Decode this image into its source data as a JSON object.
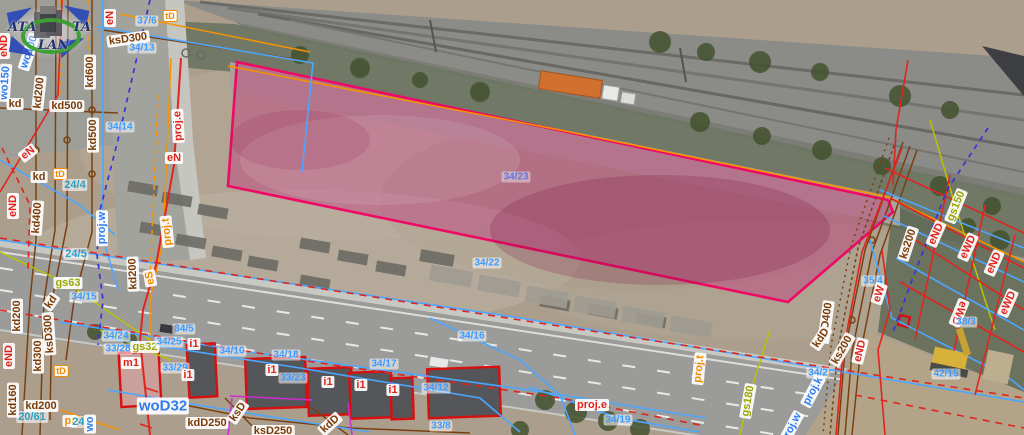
{
  "watermark": {
    "left": "ATA",
    "right": "TA",
    "bottom": "LAN"
  },
  "selected_parcel": {
    "number": "34/23",
    "outline_color": "#ee0a64",
    "fill_color": "#c2357f"
  },
  "palette": {
    "cadastral_blue": "#4da6ff",
    "utility_red": "#e0251f",
    "sewer_brown": "#7a4012",
    "telecom_orange": "#f59300",
    "gas_olive": "#b8c400",
    "proj_navy": "#3434d8",
    "magenta": "#cf2bd0"
  },
  "labels": [
    {
      "t": "eN",
      "x": 110,
      "y": 18,
      "r": -90,
      "k": "red"
    },
    {
      "t": "eND",
      "x": 4,
      "y": 46,
      "r": -90,
      "k": "red"
    },
    {
      "t": "ksD300",
      "x": 128,
      "y": 39,
      "r": -8,
      "k": "brown"
    },
    {
      "t": "34/13",
      "x": 142,
      "y": 48,
      "r": 0,
      "k": "parcel"
    },
    {
      "t": "37/6",
      "x": 147,
      "y": 21,
      "r": 0,
      "k": "parcel"
    },
    {
      "t": "tD",
      "x": 170,
      "y": 16,
      "r": 0,
      "k": "obox"
    },
    {
      "t": "wo100",
      "x": 29,
      "y": 52,
      "r": -72,
      "k": "blue"
    },
    {
      "t": "wo150",
      "x": 5,
      "y": 83,
      "r": -86,
      "k": "blue"
    },
    {
      "t": "kd600",
      "x": 90,
      "y": 72,
      "r": -90,
      "k": "brown"
    },
    {
      "t": "kd",
      "x": 15,
      "y": 104,
      "r": 0,
      "k": "brown"
    },
    {
      "t": "kd200",
      "x": 39,
      "y": 93,
      "r": -84,
      "k": "brown"
    },
    {
      "t": "kd500",
      "x": 67,
      "y": 106,
      "r": 0,
      "k": "brown"
    },
    {
      "t": "kd500",
      "x": 93,
      "y": 135,
      "r": -90,
      "k": "brown"
    },
    {
      "t": "34/14",
      "x": 120,
      "y": 127,
      "r": 0,
      "k": "parcel"
    },
    {
      "t": "eN",
      "x": 28,
      "y": 153,
      "r": -38,
      "k": "red"
    },
    {
      "t": "kd",
      "x": 39,
      "y": 177,
      "r": 0,
      "k": "brown"
    },
    {
      "t": "tD",
      "x": 60,
      "y": 174,
      "r": 0,
      "k": "obox"
    },
    {
      "t": "24/4",
      "x": 75,
      "y": 185,
      "r": 0,
      "k": "teal"
    },
    {
      "t": "eND",
      "x": 13,
      "y": 206,
      "r": -90,
      "k": "red"
    },
    {
      "t": "kd400",
      "x": 37,
      "y": 218,
      "r": -86,
      "k": "brown"
    },
    {
      "t": "proj.w",
      "x": 102,
      "y": 228,
      "r": -90,
      "k": "blue"
    },
    {
      "t": "proj.e",
      "x": 178,
      "y": 126,
      "r": -93,
      "k": "red"
    },
    {
      "t": "eN",
      "x": 174,
      "y": 158,
      "r": 0,
      "k": "red"
    },
    {
      "t": "proj.t",
      "x": 167,
      "y": 232,
      "r": -96,
      "k": "orange"
    },
    {
      "t": "eS",
      "x": 150,
      "y": 278,
      "r": -100,
      "k": "orange"
    },
    {
      "t": "kd200",
      "x": 133,
      "y": 274,
      "r": -92,
      "k": "brown"
    },
    {
      "t": "24/5",
      "x": 76,
      "y": 254,
      "r": 0,
      "k": "teal"
    },
    {
      "t": "gs63",
      "x": 68,
      "y": 283,
      "r": 0,
      "k": "olive"
    },
    {
      "t": "34/15",
      "x": 84,
      "y": 297,
      "r": 0,
      "k": "parcel"
    },
    {
      "t": "kd200",
      "x": 17,
      "y": 316,
      "r": -90,
      "k": "brown"
    },
    {
      "t": "kd",
      "x": 51,
      "y": 302,
      "r": -55,
      "k": "brown"
    },
    {
      "t": "ksD300",
      "x": 49,
      "y": 334,
      "r": -94,
      "k": "brown"
    },
    {
      "t": "kd300",
      "x": 38,
      "y": 356,
      "r": -90,
      "k": "brown"
    },
    {
      "t": "eND",
      "x": 9,
      "y": 356,
      "r": -90,
      "k": "red"
    },
    {
      "t": "tD",
      "x": 61,
      "y": 371,
      "r": 0,
      "k": "obox"
    },
    {
      "t": "kd160",
      "x": 13,
      "y": 400,
      "r": -90,
      "k": "brown"
    },
    {
      "t": "kd200",
      "x": 41,
      "y": 406,
      "r": 0,
      "k": "brown"
    },
    {
      "t": "20/61",
      "x": 32,
      "y": 417,
      "r": 0,
      "k": "teal"
    },
    {
      "t": "pr",
      "x": 70,
      "y": 421,
      "r": 0,
      "k": "orange"
    },
    {
      "t": "24/6",
      "x": 83,
      "y": 422,
      "r": 0,
      "k": "teal"
    },
    {
      "t": "wo",
      "x": 90,
      "y": 424,
      "r": -90,
      "k": "blue"
    },
    {
      "t": "34/24",
      "x": 116,
      "y": 336,
      "r": 0,
      "k": "parcel"
    },
    {
      "t": "33/28",
      "x": 118,
      "y": 349,
      "r": 0,
      "k": "parcel"
    },
    {
      "t": "gs32",
      "x": 145,
      "y": 347,
      "r": 0,
      "k": "olive"
    },
    {
      "t": "34/25",
      "x": 169,
      "y": 342,
      "r": 0,
      "k": "parcel"
    },
    {
      "t": "34/5",
      "x": 184,
      "y": 329,
      "r": 0,
      "k": "parcel"
    },
    {
      "t": "m1",
      "x": 131,
      "y": 363,
      "r": 0,
      "k": "red"
    },
    {
      "t": "i1",
      "x": 194,
      "y": 344,
      "r": 0,
      "k": "red"
    },
    {
      "t": "33/29",
      "x": 175,
      "y": 368,
      "r": 0,
      "k": "parcel"
    },
    {
      "t": "i1",
      "x": 188,
      "y": 375,
      "r": 0,
      "k": "red"
    },
    {
      "t": "34/10",
      "x": 232,
      "y": 351,
      "r": 0,
      "k": "parcel"
    },
    {
      "t": "34/18",
      "x": 286,
      "y": 355,
      "r": 0,
      "k": "parcel"
    },
    {
      "t": "i1",
      "x": 272,
      "y": 370,
      "r": 0,
      "k": "red"
    },
    {
      "t": "33/23",
      "x": 293,
      "y": 378,
      "r": 0,
      "k": "parcel"
    },
    {
      "t": "34/17",
      "x": 384,
      "y": 364,
      "r": 0,
      "k": "parcel"
    },
    {
      "t": "i1",
      "x": 328,
      "y": 382,
      "r": 0,
      "k": "red"
    },
    {
      "t": "i1",
      "x": 361,
      "y": 385,
      "r": 0,
      "k": "red"
    },
    {
      "t": "i1",
      "x": 393,
      "y": 390,
      "r": 0,
      "k": "red"
    },
    {
      "t": "34/12",
      "x": 436,
      "y": 388,
      "r": 0,
      "k": "parcel"
    },
    {
      "t": "33/8",
      "x": 441,
      "y": 426,
      "r": 0,
      "k": "parcel"
    },
    {
      "t": "34/16",
      "x": 472,
      "y": 336,
      "r": 0,
      "k": "parcel"
    },
    {
      "t": "34/22",
      "x": 487,
      "y": 263,
      "r": 0,
      "k": "parcel"
    },
    {
      "t": "34/23",
      "x": 516,
      "y": 177,
      "r": 0,
      "k": "parcelhl"
    },
    {
      "t": "woD32",
      "x": 163,
      "y": 406,
      "r": 0,
      "k": "blue",
      "lg": true
    },
    {
      "t": "kdD250",
      "x": 207,
      "y": 423,
      "r": 0,
      "k": "brown"
    },
    {
      "t": "ksD",
      "x": 238,
      "y": 412,
      "r": -55,
      "k": "brown"
    },
    {
      "t": "ksD250",
      "x": 273,
      "y": 431,
      "r": 0,
      "k": "brown"
    },
    {
      "t": "kdD",
      "x": 330,
      "y": 424,
      "r": -42,
      "k": "brown"
    },
    {
      "t": "proj.e",
      "x": 592,
      "y": 405,
      "r": 0,
      "k": "red"
    },
    {
      "t": "34/19",
      "x": 618,
      "y": 420,
      "r": 0,
      "k": "parcel"
    },
    {
      "t": "proj.t",
      "x": 699,
      "y": 369,
      "r": -84,
      "k": "orange"
    },
    {
      "t": "gs180",
      "x": 748,
      "y": 401,
      "r": -80,
      "k": "olive"
    },
    {
      "t": "proj.k",
      "x": 813,
      "y": 391,
      "r": -62,
      "k": "blue"
    },
    {
      "t": "34/2",
      "x": 818,
      "y": 373,
      "r": 0,
      "k": "parcel"
    },
    {
      "t": "proj.w",
      "x": 791,
      "y": 428,
      "r": -62,
      "k": "blue"
    },
    {
      "t": "kdD400",
      "x": 826,
      "y": 322,
      "r": -82,
      "k": "brown"
    },
    {
      "t": "kdD",
      "x": 821,
      "y": 338,
      "r": -56,
      "k": "brown"
    },
    {
      "t": "ks200",
      "x": 842,
      "y": 350,
      "r": -60,
      "k": "brown"
    },
    {
      "t": "eND",
      "x": 860,
      "y": 351,
      "r": -76,
      "k": "red"
    },
    {
      "t": "35/4",
      "x": 873,
      "y": 281,
      "r": 0,
      "k": "parcel"
    },
    {
      "t": "eW",
      "x": 879,
      "y": 294,
      "r": -72,
      "k": "red"
    },
    {
      "t": "ks200",
      "x": 908,
      "y": 244,
      "r": -72,
      "k": "brown"
    },
    {
      "t": "eND",
      "x": 936,
      "y": 234,
      "r": -66,
      "k": "red"
    },
    {
      "t": "gs150",
      "x": 956,
      "y": 206,
      "r": -68,
      "k": "olive"
    },
    {
      "t": "eWD",
      "x": 968,
      "y": 247,
      "r": -66,
      "k": "red"
    },
    {
      "t": "eND",
      "x": 994,
      "y": 263,
      "r": -66,
      "k": "red"
    },
    {
      "t": "eWD",
      "x": 1008,
      "y": 303,
      "r": -66,
      "k": "red"
    },
    {
      "t": "eWD",
      "x": 959,
      "y": 313,
      "r": 112,
      "k": "red"
    },
    {
      "t": "38/3",
      "x": 966,
      "y": 322,
      "r": 0,
      "k": "parcel"
    },
    {
      "t": "42/15",
      "x": 946,
      "y": 374,
      "r": 0,
      "k": "parcel"
    }
  ]
}
